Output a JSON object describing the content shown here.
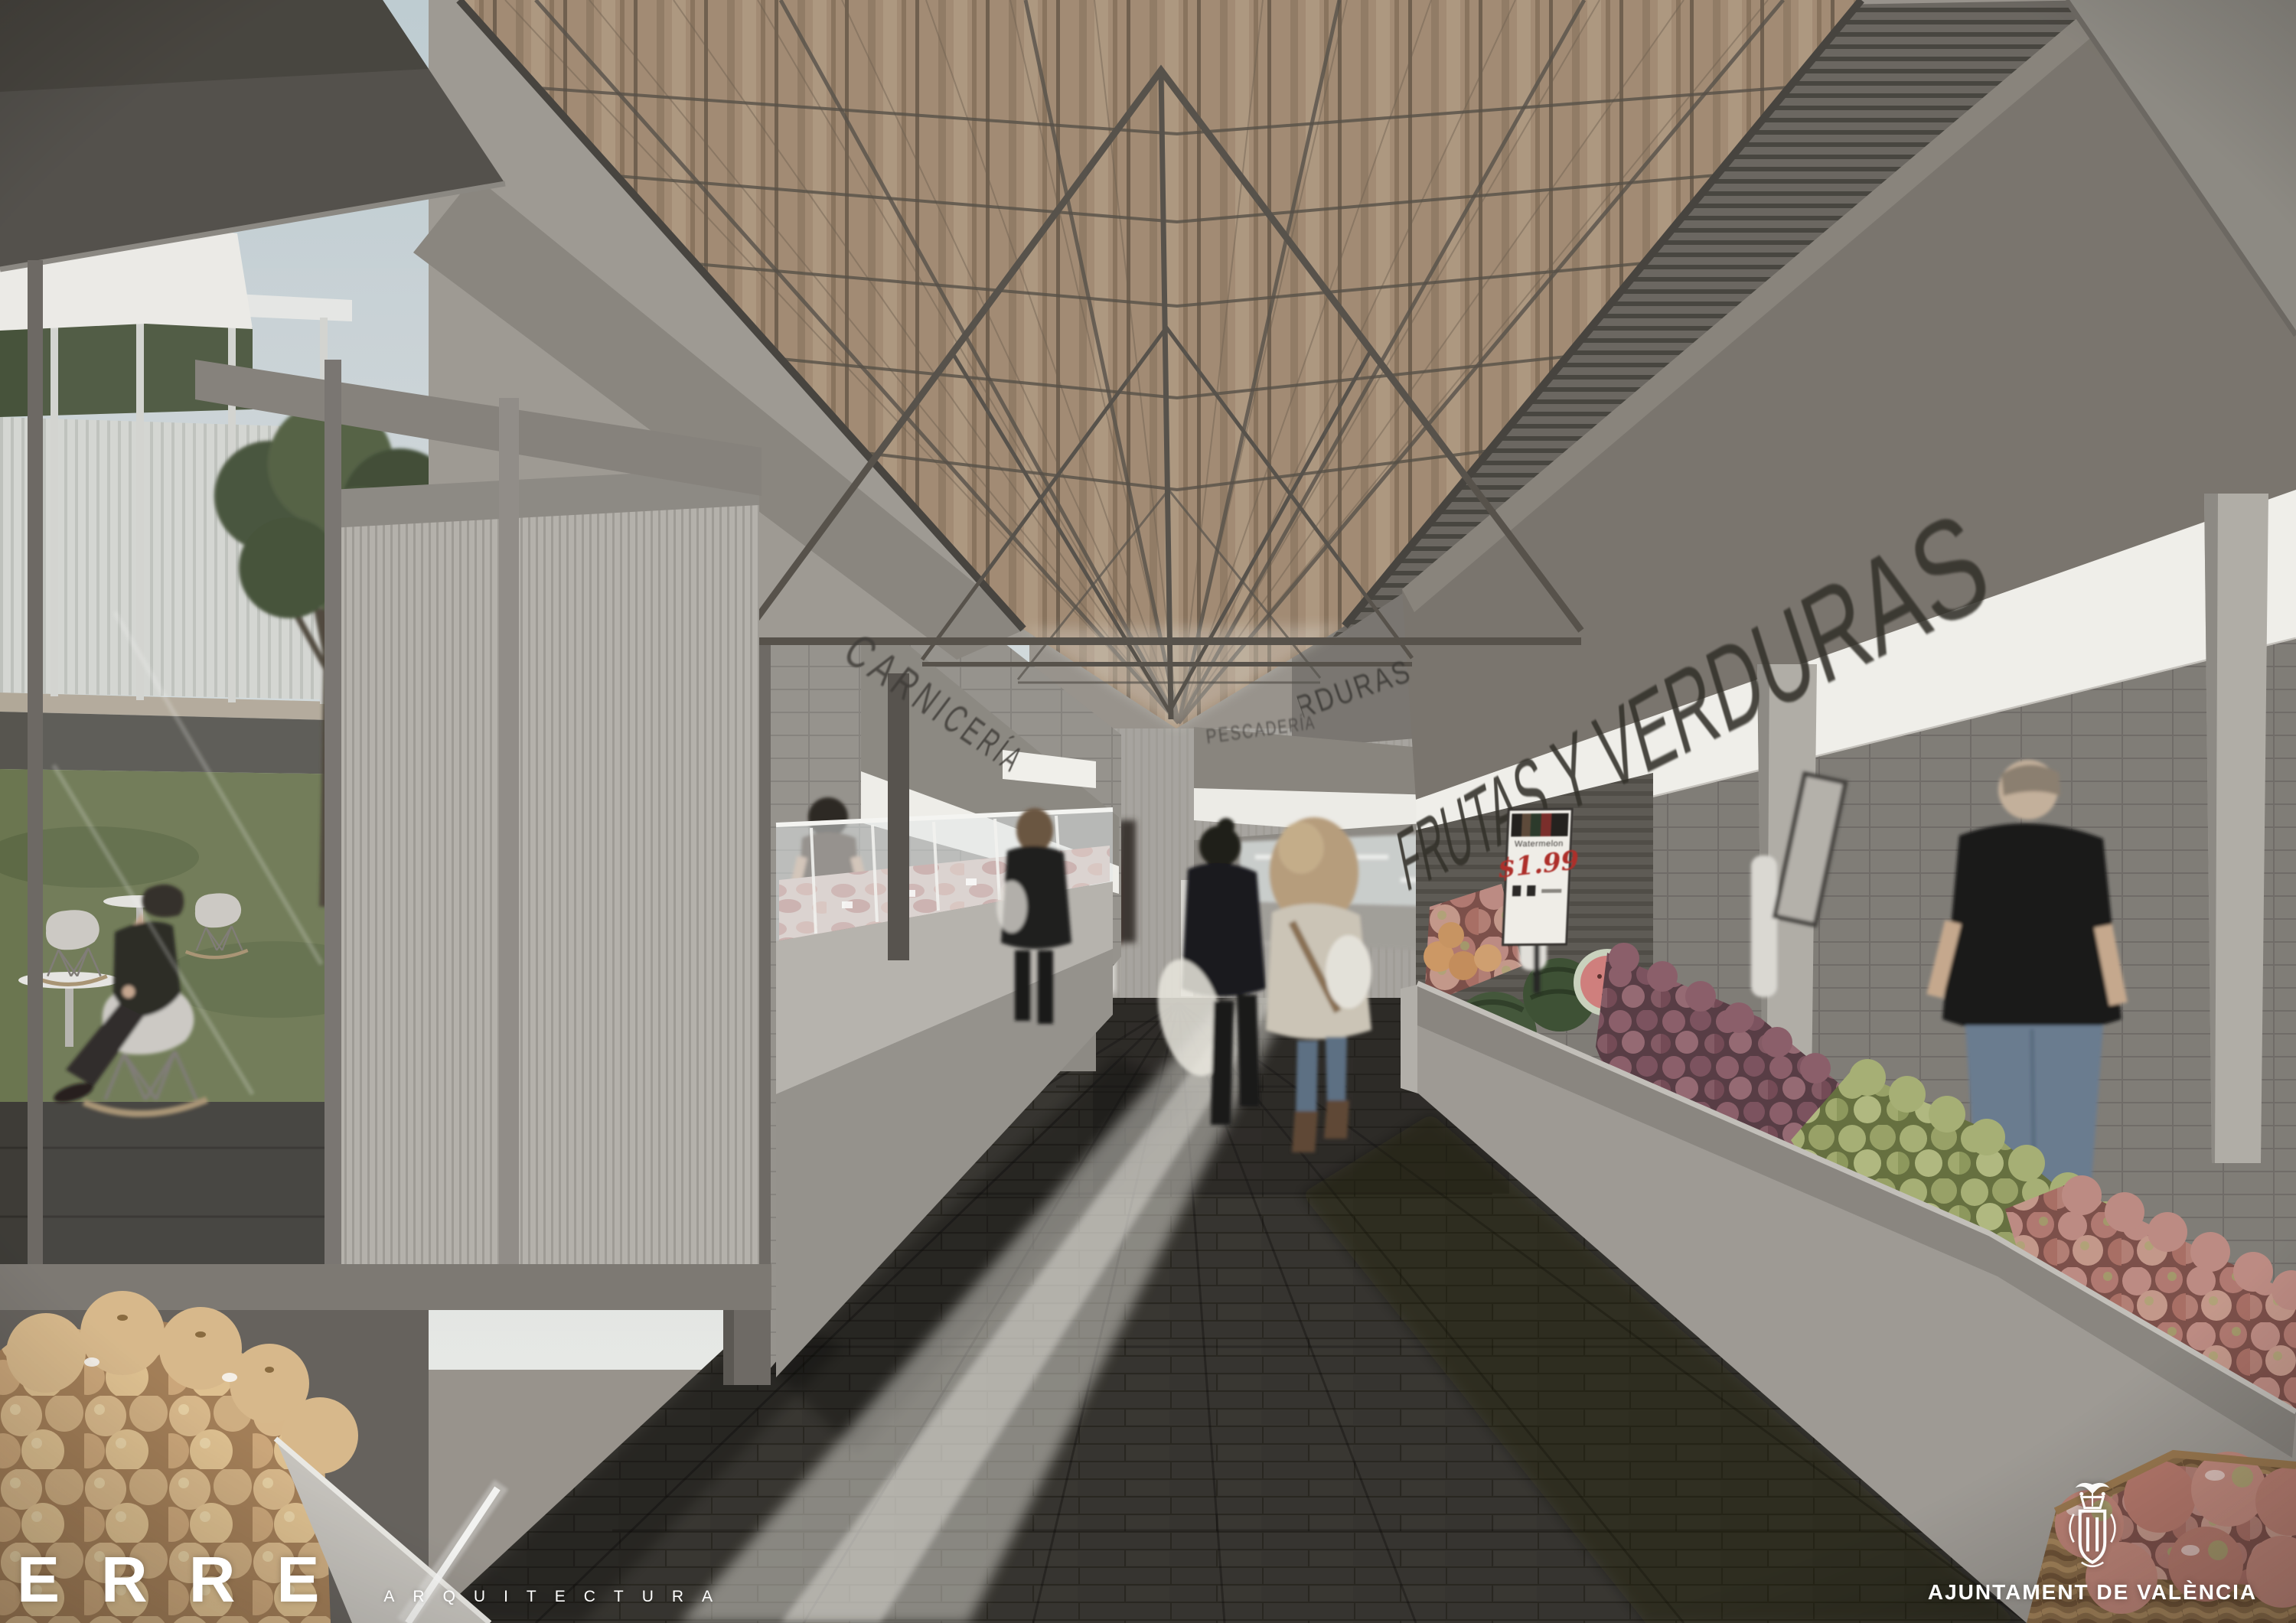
{
  "signs": {
    "carniceria": "CARNICERÍA",
    "frutas_far": "FRUTAS Y VERDURAS",
    "frutas_near": "FRUTAS Y VERDURAS",
    "pescaderia": "PESCADERÍA"
  },
  "price_tag": {
    "product": "Watermelon",
    "price": "$1.99"
  },
  "branding": {
    "studio": "ERRE",
    "studio_suffix": "ARQUITECTURA",
    "municipality": "AJUNTAMENT DE VALÈNCIA"
  },
  "colors": {
    "wood_ceiling": "#a58d76",
    "steel_truss": "#56514b",
    "soffit_white": "#f4f3ef",
    "concrete_gray": "#8d8984",
    "price_red": "#ad2f2a",
    "sky": "#c5d3d9"
  }
}
